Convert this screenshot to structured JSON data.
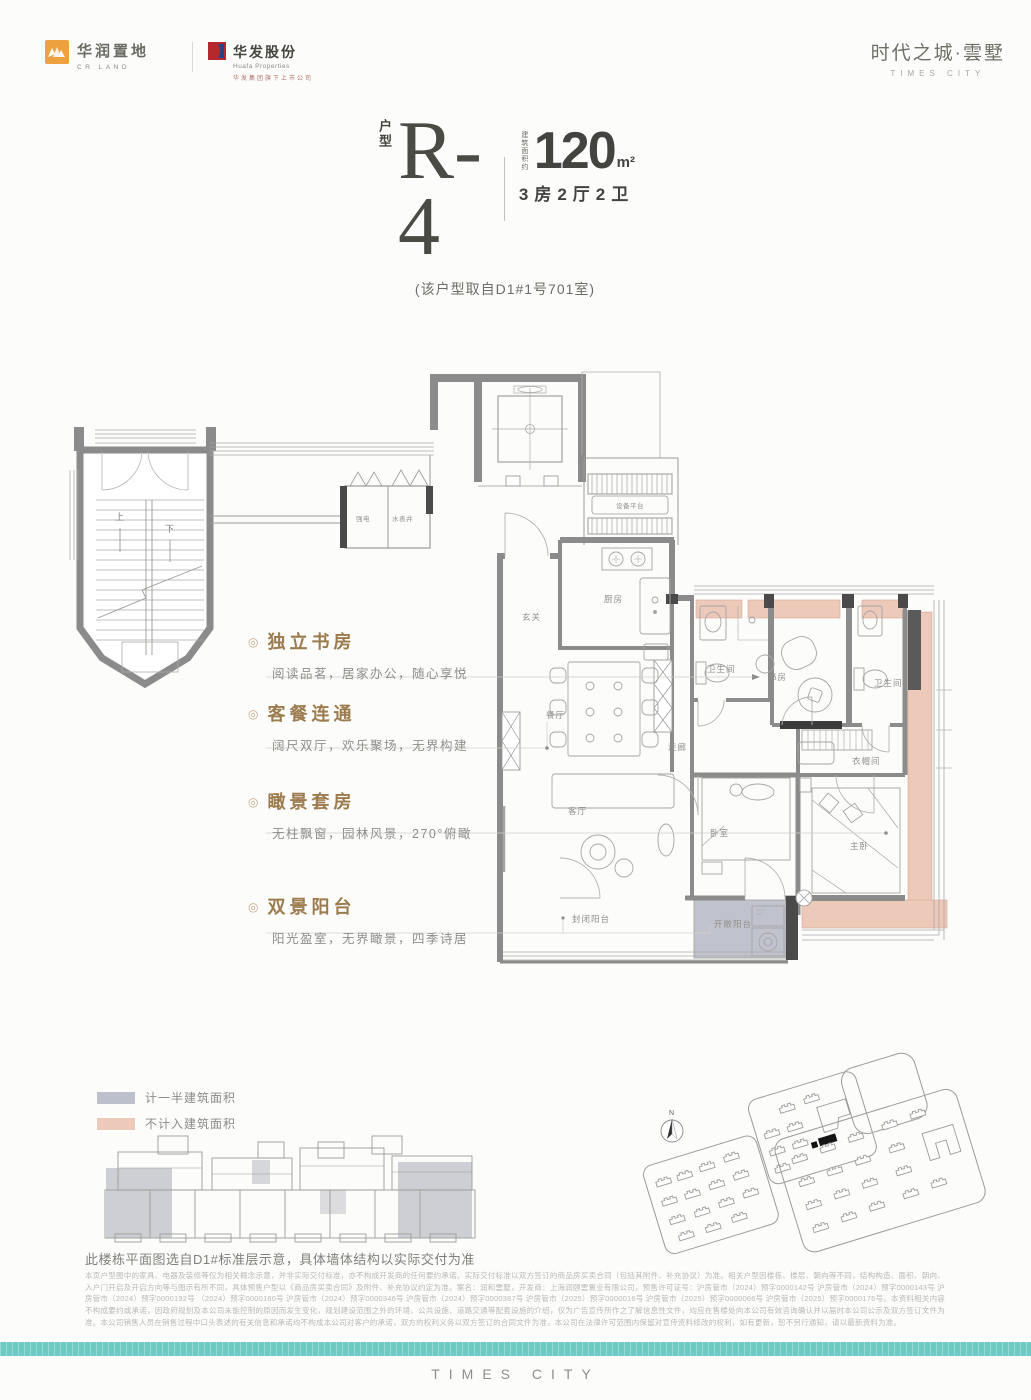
{
  "brand": {
    "cr_name": "华润置地",
    "cr_sub": "CR LAND",
    "huafa_name": "华发股份",
    "huafa_sub": "Huafa Properties",
    "huafa_tagline": "华发集团旗下上市公司",
    "project_name": "时代之城·雲墅",
    "project_latin": "TIMES CITY"
  },
  "title": {
    "unit_label": "户型",
    "unit_code": "R-4",
    "area_prefix": "建筑面积约",
    "area_value": "120",
    "area_unit": "m²",
    "rooms": "3房2厅2卫",
    "source_note": "(该户型取自D1#1号701室)"
  },
  "features": [
    {
      "title": "独立书房",
      "desc": "阅读品茗，居家办公，随心享悦"
    },
    {
      "title": "客餐连通",
      "desc": "阔尺双厅，欢乐聚场，无界构建"
    },
    {
      "title": "瞰景套房",
      "desc": "无柱飘窗，园林风景，270°俯瞰"
    },
    {
      "title": "双景阳台",
      "desc": "阳光盈室，无界瞰景，四季诗居"
    }
  ],
  "plan_labels": {
    "equipment": "设备平台",
    "strong_electric": "强电",
    "water_meter": "水表井",
    "up": "上",
    "down": "下",
    "foyer": "玄关",
    "kitchen": "厨房",
    "dining": "餐厅",
    "corridor": "走廊",
    "bath_guest": "卫生间",
    "study": "书房",
    "bath_master": "卫生间",
    "closet": "衣帽间",
    "living": "客厅",
    "bedroom": "卧室",
    "master": "主卧",
    "balcony_enclosed": "封闭阳台",
    "balcony_open": "开敞阳台"
  },
  "legend": [
    {
      "label": "计一半建筑面积",
      "color": "#bcc0cc"
    },
    {
      "label": "不计入建筑面积",
      "color": "#edc9ba"
    }
  ],
  "key_plan_note": "此楼栋平面图选自D1#标准层示意，具体墙体结构以实际交付为准",
  "compass": "N",
  "disclaimer": "本页户型图中的家具、电器及装修等仅为相关概念示意，并非实际交付标准，亦不构成开发商的任何要约承诺。实际交付标准以双方签订的商品房买卖合同（包括其附件、补充协议）为准。相关户型因楼栋、楼层、朝向等不同，结构构造、面积、朝向、入户门开启及开启方向等与图示有所不同，具体预售户型以《商品房买卖合同》及附件、补充协议约定为准。案名：润和雲墅，开发商：上海润颐雲置业有限公司，预售许可证号：沪房管市（2024）预字0000142号 沪房管市（2024）预字0000143号 沪房管市（2024）预字0000192号 （2024）预字0000160号 沪房管市（2024）预字0000346号 沪房管市（2024）预字0000367号 沪房管市（2025）预字0000016号 沪房管市（2025）预字0000066号 沪房管市（2025）预字0000176号。本资料相关内容不构成要约或承诺，因政府规划及本公司未能控制的原因而发生变化，规划建设范围之外的环境、公共设施、道路交通等配套设施的介绍，仅为广告宣传所作之了解信息性文件，均应在售楼处向本公司有效咨询确认并以届时本公司公示及双方签订文件为准。本公司销售人员在销售过程中口头表述的有关信息和承诺均不构成本公司对客户的承诺，双方的权利义务以双方签订的合同文件为准，本公司在法律许可范围内保留对宣传资料修改的权利，如有更新，恕不另行通知，请以最新资料为准。",
  "footer_brand": "TIMES CITY",
  "colors": {
    "accent_teal": "#6fcac3",
    "feature_title": "#9c7c4e",
    "wall_gray": "#8b8b8b",
    "bay_pink": "#edc9ba",
    "half_area_gray": "#bcc0cc",
    "cr_orange": "#eda13f",
    "huafa_red": "#b5282d",
    "huafa_blue": "#27418a"
  }
}
